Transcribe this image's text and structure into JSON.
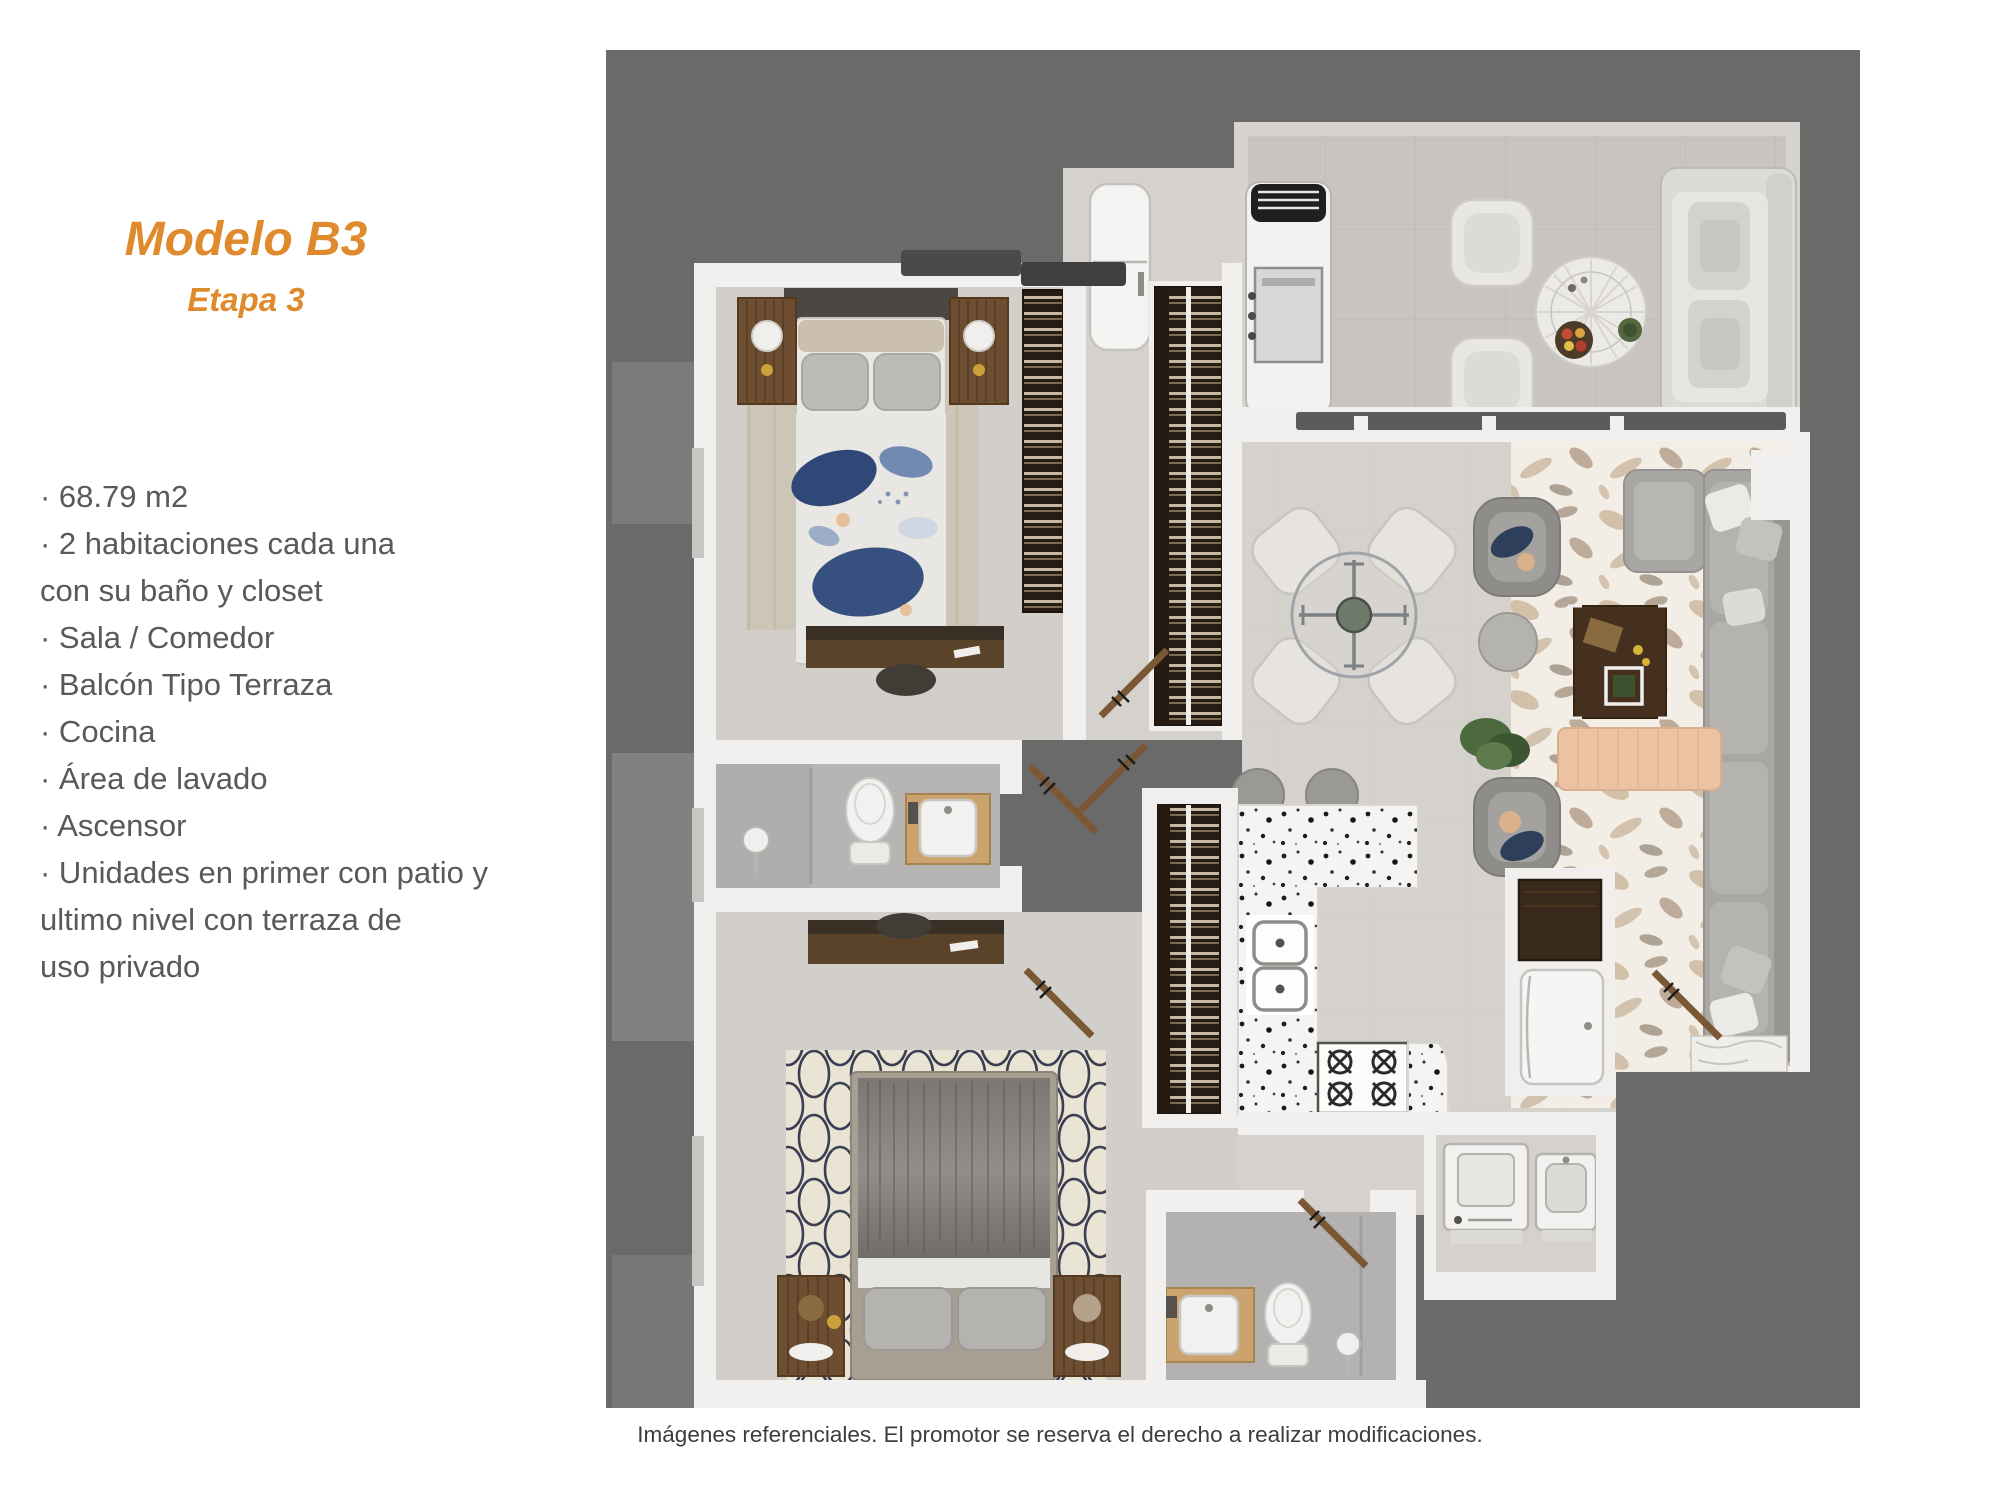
{
  "page": {
    "title": "Modelo B3",
    "subtitle": "Etapa 3",
    "features_lines": [
      "· 68.79 m2",
      "· 2 habitaciones cada una",
      "con su baño y closet",
      "· Sala / Comedor",
      "· Balcón Tipo Terraza",
      "· Cocina",
      "· Área de lavado",
      "· Ascensor",
      "· Unidades en primer con patio y",
      "ultimo nivel con terraza de",
      "uso privado"
    ],
    "caption": "Imágenes referenciales. El promotor se reserva el derecho a realizar modificaciones."
  },
  "colors": {
    "accent_orange": "#E08A2E",
    "feature_text_gray": "#595959",
    "caption_gray": "#3D3D3D",
    "plan_background_gray": "#6A6A6A",
    "wall_white": "#F1F0EE",
    "floor_beige": "#D5D2CD",
    "terrace_tile": "#C8C5C1",
    "bath_tile": "#B7B5B3",
    "closet_wood_dark": "#2C211A",
    "bed1_duvet_blue": "#31487A",
    "bench_peach": "#ECC3A2"
  },
  "floorplan": {
    "type": "apartment-top-view-render",
    "rooms": [
      "balcon-terraza",
      "sala-comedor",
      "cocina",
      "habitacion-principal",
      "habitacion-2",
      "bano-1",
      "bano-2",
      "area-de-lavado",
      "closets",
      "pasillo"
    ],
    "furniture": [
      "bbq-grill",
      "outdoor-sofa",
      "outdoor-chairs",
      "round-patio-table",
      "dining-glass-table",
      "dining-chairs",
      "sectional-sofa",
      "armchairs",
      "coffee-table",
      "side-table",
      "plant",
      "bench",
      "bed-blue-duvet",
      "bed-gray-duvet",
      "nightstands",
      "lamps",
      "desks",
      "toilets",
      "sinks",
      "shower-glass",
      "kitchen-counter-terrazzo",
      "double-sink",
      "stove",
      "bar-stools",
      "refrigerator",
      "cabinet",
      "washer",
      "laundry-tub",
      "doors"
    ]
  }
}
